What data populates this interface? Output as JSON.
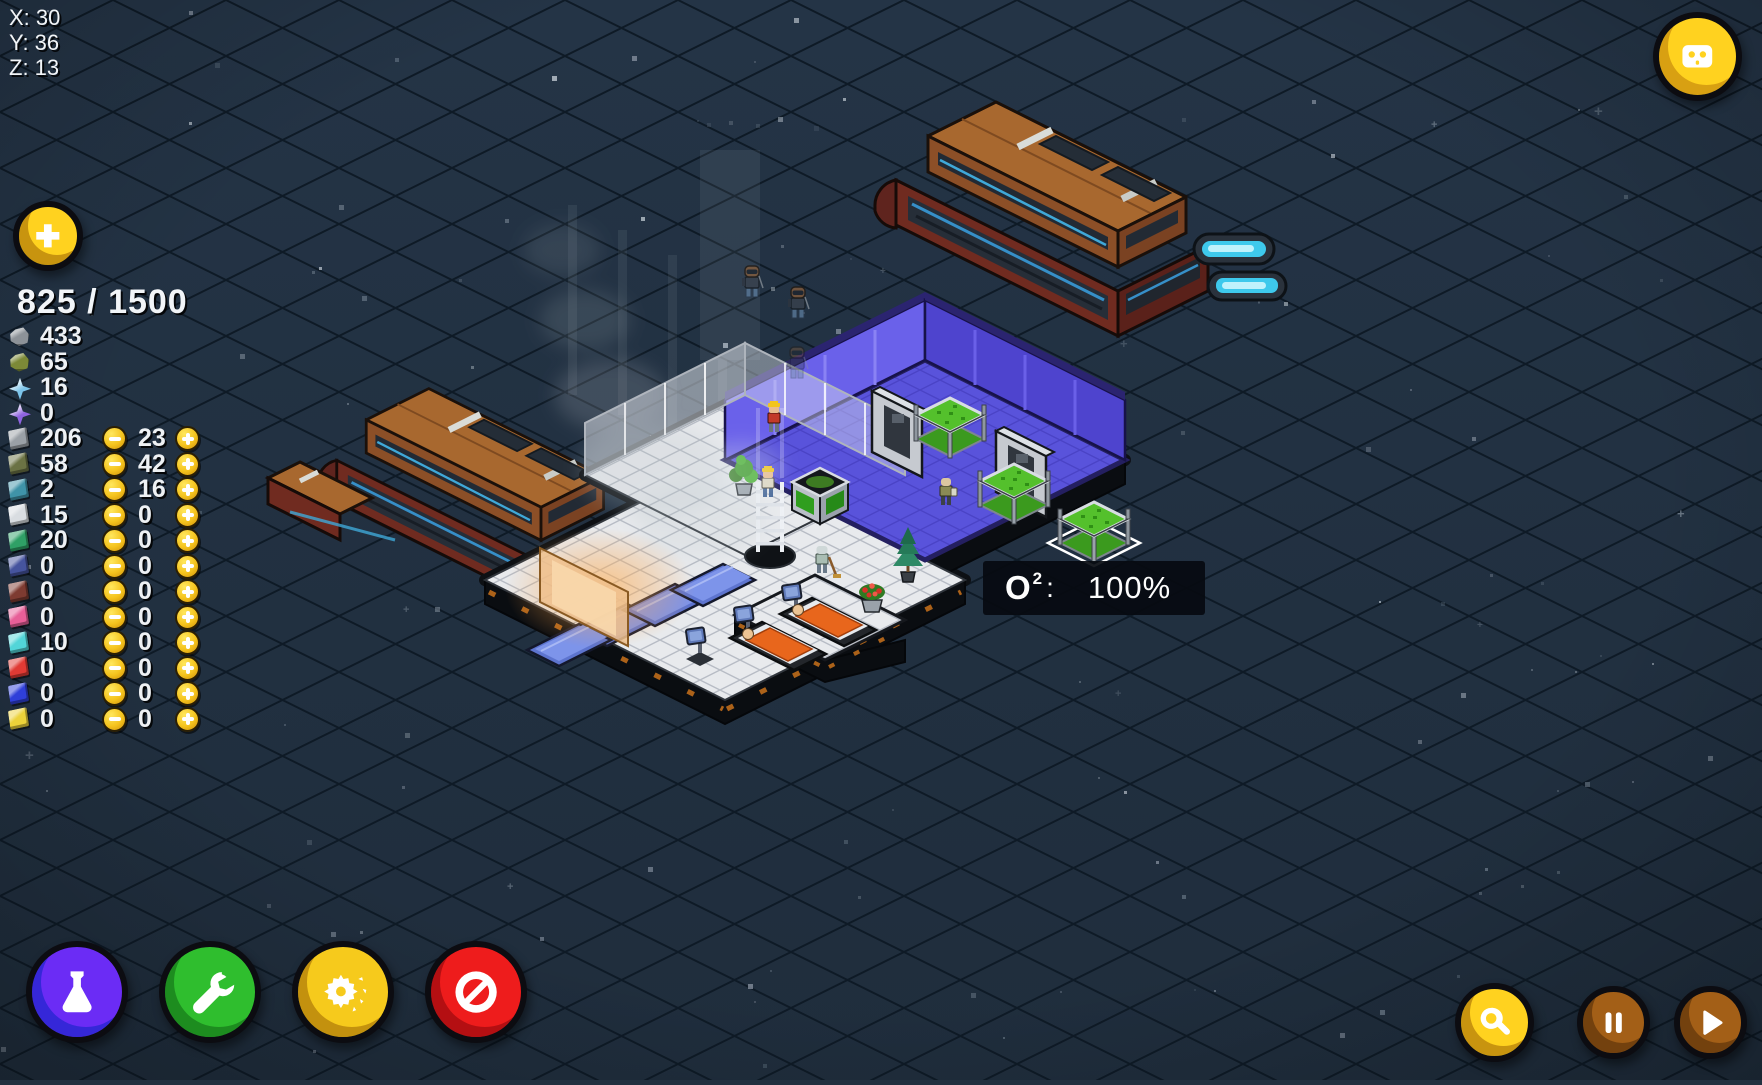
{
  "hud": {
    "coordinates": {
      "x": "X: 30",
      "y": "Y: 36",
      "z": "Z: 13"
    },
    "storage": {
      "display": "825 / 1500"
    },
    "resource_panel": {
      "raw": [
        {
          "name": "gray-rock",
          "shape": "rock",
          "color": "#8d9298",
          "count": "433"
        },
        {
          "name": "organic-rock",
          "shape": "rock",
          "color": "#7c8937",
          "count": "65"
        },
        {
          "name": "blue-crystal",
          "shape": "crystal",
          "color": "#7cc4ea",
          "count": "16"
        },
        {
          "name": "purple-crystal",
          "shape": "crystal",
          "color": "#8f63e0",
          "count": "0"
        }
      ],
      "goods": [
        {
          "name": "gray-plate",
          "color": "#9aa0a6",
          "count": "206",
          "price": "23"
        },
        {
          "name": "olive-plate",
          "color": "#6b7244",
          "count": "58",
          "price": "42"
        },
        {
          "name": "teal-plate",
          "color": "#3f93a8",
          "count": "2",
          "price": "16"
        },
        {
          "name": "white-plate",
          "color": "#d9dde1",
          "count": "15",
          "price": "0"
        },
        {
          "name": "green-plate",
          "color": "#2fa066",
          "count": "20",
          "price": "0"
        },
        {
          "name": "navy-plate",
          "color": "#46549e",
          "count": "0",
          "price": "0"
        },
        {
          "name": "maroon-plate",
          "color": "#7e3b31",
          "count": "0",
          "price": "0"
        },
        {
          "name": "pink-plate",
          "color": "#e75f98",
          "count": "0",
          "price": "0"
        },
        {
          "name": "cyan-plate",
          "color": "#52d5d8",
          "count": "10",
          "price": "0"
        },
        {
          "name": "red-plate",
          "color": "#e03a34",
          "count": "0",
          "price": "0"
        },
        {
          "name": "blue-plate",
          "color": "#2f3fd9",
          "count": "0",
          "price": "0"
        },
        {
          "name": "yellow-plate",
          "color": "#ecd23a",
          "count": "0",
          "price": "0"
        }
      ]
    },
    "tooltip": {
      "gas": "O",
      "sup": "2",
      "colon": ":",
      "value": "100%"
    }
  },
  "controls": {
    "add_button": {
      "name": "add",
      "icon": "plus-icon",
      "color": "#ffd21f",
      "shade": "#c8940f"
    },
    "crew_button": {
      "name": "crew",
      "icon": "robot-face-icon",
      "color": "#ffd21f",
      "shade": "#d8a012"
    },
    "toolbar": [
      {
        "name": "research",
        "icon": "flask-icon",
        "color": "#6b2cf5",
        "shade": "#3527d8"
      },
      {
        "name": "build",
        "icon": "wrench-icon",
        "color": "#2fbe2e",
        "shade": "#1d8c1f"
      },
      {
        "name": "mine",
        "icon": "broken-gear-icon",
        "color": "#f6ca1c",
        "shade": "#c3910e"
      },
      {
        "name": "forbid",
        "icon": "ban-icon",
        "color": "#ee1c1c",
        "shade": "#b40f12"
      }
    ],
    "view": [
      {
        "name": "zoom",
        "icon": "magnifier-icon",
        "color": "#ffd21f",
        "shade": "#c8940f"
      }
    ],
    "time": [
      {
        "name": "pause",
        "icon": "pause-icon",
        "color": "#a35f17",
        "shade": "#73410e"
      },
      {
        "name": "play",
        "icon": "play-icon",
        "color": "#a35f17",
        "shade": "#73410e"
      }
    ]
  },
  "palette": {
    "background": "#223140",
    "grid_line": "#0e1a26",
    "coin_gold": "#f5c31d",
    "oxygen_box": "#070a10",
    "blue_room_wall": "#5f55e0",
    "ship_hull": "#a8682f",
    "engine_glow": "#3ec9ec",
    "text": "#ffffff"
  }
}
